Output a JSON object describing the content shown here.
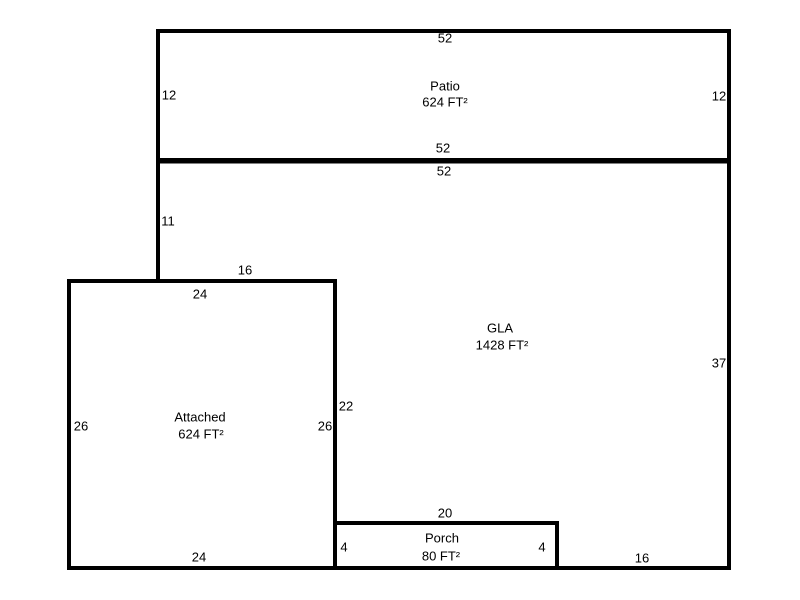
{
  "floorplan": {
    "colors": {
      "line": "#000000",
      "text": "#000000",
      "background": "#ffffff"
    },
    "rooms": [
      {
        "name": "Patio",
        "area": "624 FT²",
        "dimensions": {
          "top": "52",
          "bottom": "52",
          "left": "12",
          "right": "12"
        }
      },
      {
        "name": "GLA",
        "area": "1428 FT²",
        "dimensions": {
          "top": "52",
          "left_upper": "11",
          "step_top": "16",
          "left_lower": "22",
          "right": "37",
          "bottom": "16"
        }
      },
      {
        "name": "Attached",
        "area": "624 FT²",
        "dimensions": {
          "top": "24",
          "bottom": "24",
          "left": "26",
          "right": "26"
        }
      },
      {
        "name": "Porch",
        "area": "80 FT²",
        "dimensions": {
          "top": "20",
          "left": "4",
          "right": "4"
        }
      }
    ]
  }
}
